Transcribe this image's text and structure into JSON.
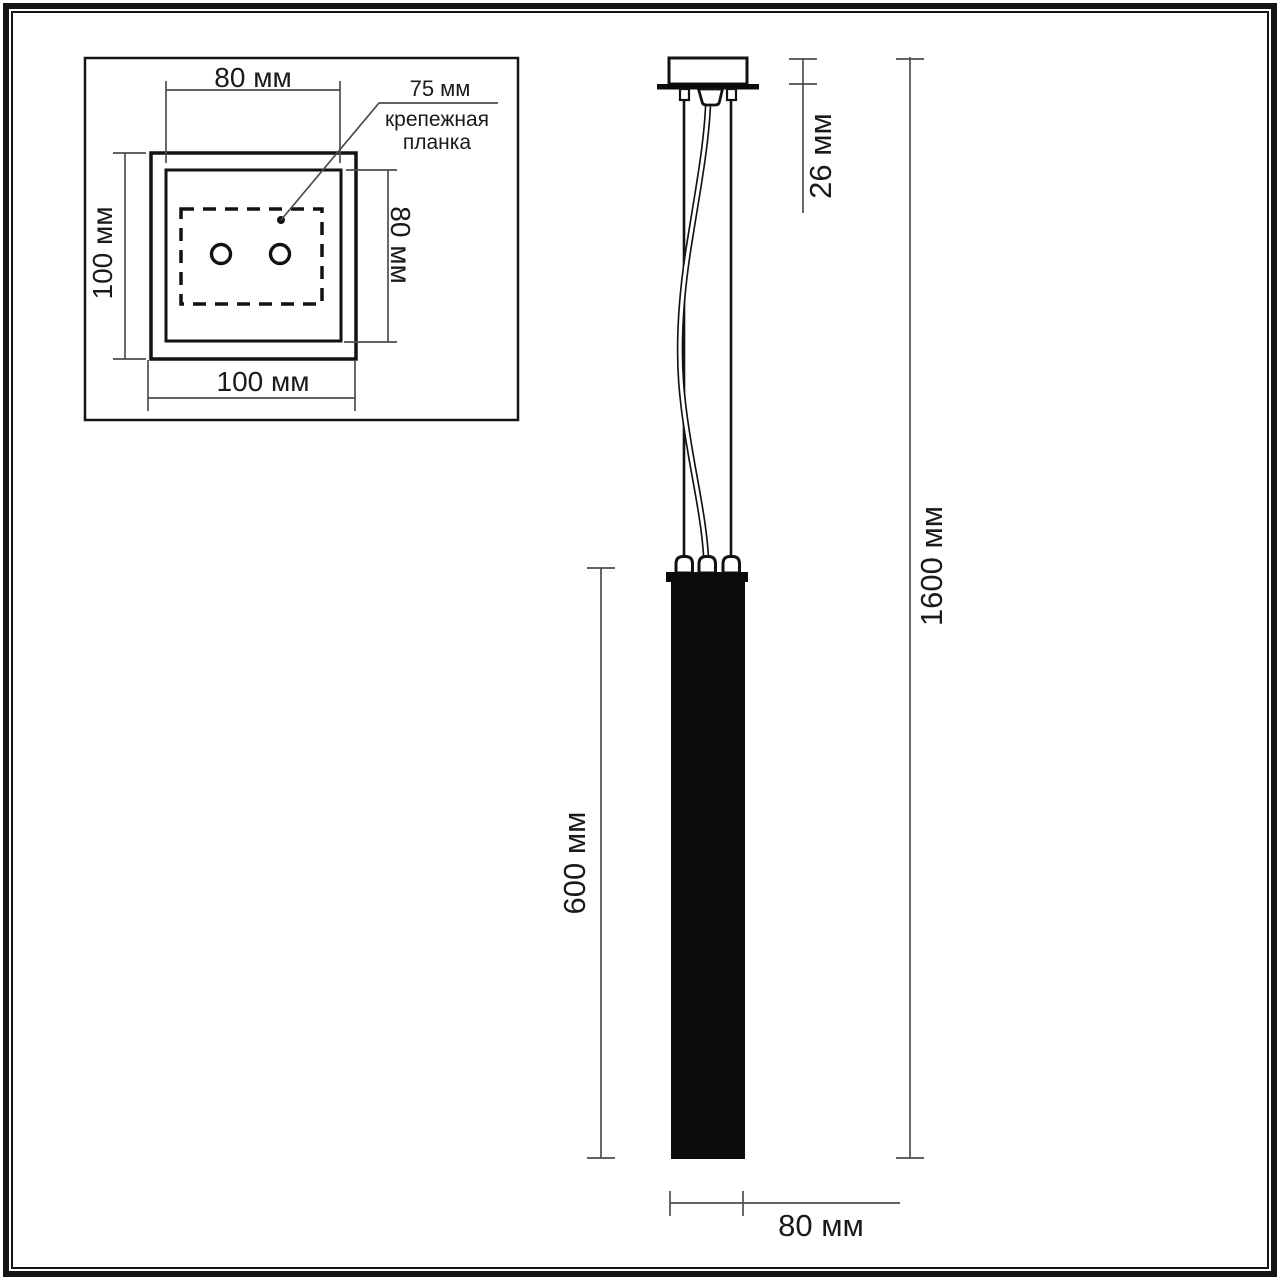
{
  "inset": {
    "dim_top": "80 мм",
    "dim_left": "100 мм",
    "dim_right": "80 мм",
    "dim_bottom": "100 мм",
    "bracket_dim": "75 мм",
    "bracket_label_line1": "крепежная",
    "bracket_label_line2": "планка"
  },
  "main": {
    "dim_canopy_height": "26 мм",
    "dim_total_height": "1600 мм",
    "dim_shade_height": "600 мм",
    "dim_shade_width": "80 мм"
  },
  "colors": {
    "drawing_line": "#121212",
    "dimension_line": "#4d4d4d",
    "fill": "#0b0b0b",
    "background": "#ffffff"
  }
}
